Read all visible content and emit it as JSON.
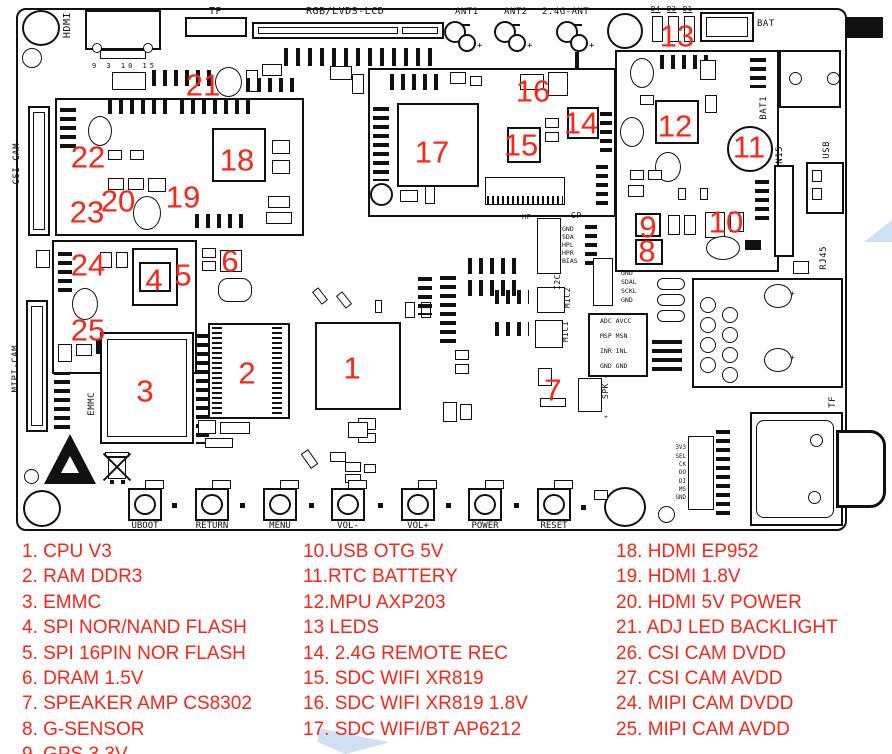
{
  "labels": {
    "hdmi": "HDMI",
    "tp": "TP",
    "lcd": "RGB/LVDS-LCD",
    "ant1": "ANT1",
    "ant2": "ANT2",
    "ant24g": "2.4G-ANT",
    "d4": "D4",
    "d3": "D3",
    "d1": "D1",
    "bat": "BAT",
    "dc": "DC",
    "csi_cam": "CSI-CAM",
    "mipi_cam": "MIPI-CAM",
    "emmc": "EMMC",
    "ver_marks": "9 3 10 15",
    "bat1": "BAT1",
    "cn15": "CN15",
    "usb": "USB",
    "rj45": "RJ45",
    "tf": "TF",
    "gp": "GP",
    "hp": "HP",
    "i2c": "I2C",
    "mic1": "MIC1",
    "mic2": "MIC2",
    "spk": "SPK",
    "plus": "+",
    "minus": "-"
  },
  "pins": {
    "i2c": [
      "GND",
      "SDAL",
      "SCKL",
      "GND"
    ],
    "gp": [
      "GND",
      "SDA",
      "HPL",
      "HPR",
      "BIAS"
    ],
    "audio": [
      "ADC AVCC",
      "MSP MSN",
      "INR INL",
      "GND GND"
    ],
    "tf": [
      "3V3",
      "SEL",
      "CK",
      "DO",
      "DI",
      "MS",
      "GND"
    ]
  },
  "buttons": [
    "UBOOT",
    "RETURN",
    "MENU",
    "VOL-",
    "VOL+",
    "POWER",
    "RESET"
  ],
  "callouts": {
    "c1": "1",
    "c2": "2",
    "c3": "3",
    "c4": "4",
    "c5": "5",
    "c6": "6",
    "c7": "7",
    "c8": "8",
    "c9": "9",
    "c10": "10",
    "c11": "11",
    "c12": "12",
    "c13": "13",
    "c14": "14",
    "c15": "15",
    "c16": "16",
    "c17": "17",
    "c18": "18",
    "c19": "19",
    "c20": "20",
    "c21": "21",
    "c22": "22",
    "c23": "23",
    "c24": "24",
    "c25": "25"
  },
  "legend": {
    "col1": [
      "1. CPU V3",
      "2. RAM DDR3",
      "3. EMMC",
      "4. SPI NOR/NAND FLASH",
      "5. SPI 16PIN NOR FLASH",
      "6. DRAM 1.5V",
      "7. SPEAKER AMP CS8302",
      "8. G-SENSOR",
      "9. GPS 3.3V"
    ],
    "col2": [
      "10.USB OTG 5V",
      "11.RTC BATTERY",
      "12.MPU AXP203",
      "13 LEDS",
      "14. 2.4G REMOTE REC",
      "15. SDC WIFI XR819",
      "16. SDC WIFI XR819 1.8V",
      "17. SDC WIFI/BT AP6212"
    ],
    "col3": [
      "18. HDMI EP952",
      "19. HDMI 1.8V",
      "20. HDMI 5V POWER",
      "21. ADJ LED BACKLIGHT",
      "26. CSI CAM DVDD",
      "27. CSI CAM AVDD",
      "24. MIPI CAM DVDD",
      "25. MIPI CAM AVDD"
    ]
  },
  "colors": {
    "annotation_red": "#fb2418",
    "line_black": "#111111",
    "watermark_blue": "#c5dcf2"
  }
}
